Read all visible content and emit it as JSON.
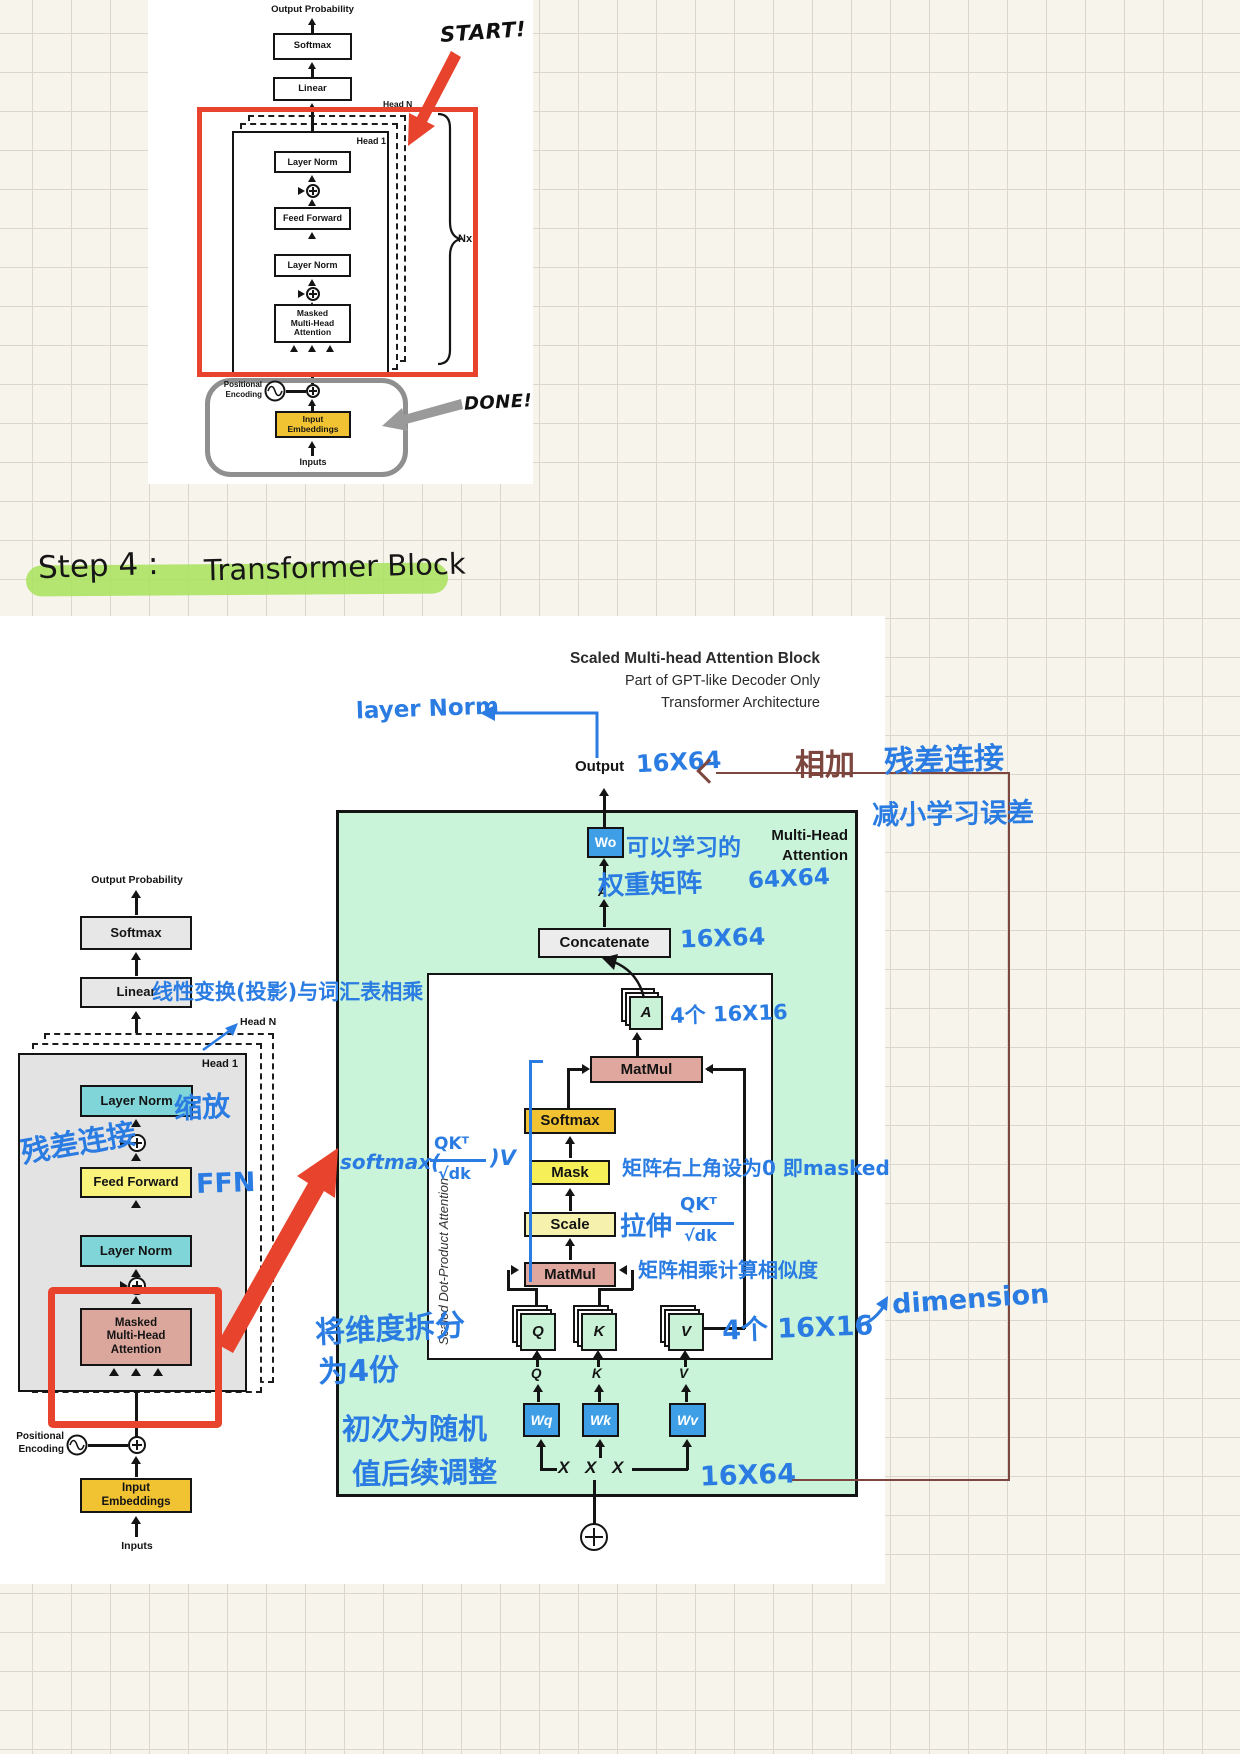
{
  "colors": {
    "accent_red": "#e8432c",
    "arrow_gray": "#999999",
    "highlight_green": "#a8e25c",
    "attention_panel_green": "#c9f4d9",
    "blue_weight_box": "#3f9fe6",
    "matmul_pink": "#dfa79d",
    "softmax_gold": "#f1c232",
    "mask_yellow": "#f7ef58",
    "scale_pale_yellow": "#f6f2ae",
    "layernorm_cyan": "#7fd5d7",
    "feedforward_yellow": "#f9f37c",
    "mha_pink": "#dba69c",
    "embedding_gold": "#f1c232",
    "handwriting_blue": "#2a7ce2",
    "handwriting_darkred": "#7d463e"
  },
  "top_diagram": {
    "output_probability": "Output Probability",
    "softmax": "Softmax",
    "linear": "Linear",
    "head_n": "Head N",
    "head_1": "Head 1",
    "layer_norm_1": "Layer Norm",
    "feed_forward": "Feed Forward",
    "layer_norm_2": "Layer Norm",
    "mha_lines": [
      "Masked",
      "Multi-Head",
      "Attention"
    ],
    "nx": "Nx",
    "positional_lines": [
      "Positional",
      "Encoding"
    ],
    "embed_lines": [
      "Input",
      "Embeddings"
    ],
    "inputs": "Inputs",
    "start": "START!",
    "done": "DONE!"
  },
  "step_title": {
    "prefix": "Step 4 :",
    "name": "Transformer Block"
  },
  "main": {
    "title1": "Scaled Multi-head Attention Block",
    "title2": "Part of GPT-like Decoder Only",
    "title3": "Transformer Architecture",
    "output": "Output",
    "left": {
      "output_probability": "Output Probability",
      "softmax": "Softmax",
      "linear": "Linear",
      "head_n": "Head N",
      "head_1": "Head 1",
      "layer_norm_1": "Layer Norm",
      "feed_forward": "Feed Forward",
      "layer_norm_2": "Layer Norm",
      "mha_lines": [
        "Masked",
        "Multi-Head",
        "Attention"
      ],
      "positional_lines": [
        "Positional",
        "Encoding"
      ],
      "embed_lines": [
        "Input",
        "Embeddings"
      ],
      "inputs": "Inputs"
    },
    "attn": {
      "mh_lines": [
        "Multi-Head",
        "Attention"
      ],
      "wo": "Wo",
      "a_small": "A",
      "concatenate": "Concatenate",
      "sdpa": "Scaled Dot-Product Attention",
      "a_card": "A",
      "matmul_top": "MatMul",
      "softmax": "Softmax",
      "mask": "Mask",
      "scale": "Scale",
      "matmul_bottom": "MatMul",
      "q": "Q",
      "k": "K",
      "v": "V",
      "q_label": "Q",
      "k_label": "K",
      "v_label": "V",
      "wq": "Wq",
      "wk": "Wk",
      "wv": "Wv",
      "x1": "X",
      "x2": "X",
      "x3": "X"
    },
    "notes": {
      "layer_norm": "layer Norm",
      "out_dim": "16X64",
      "add": "相加",
      "residual": "残差连接",
      "reduce_err": "减小学习误差",
      "learnable": "可以学习的",
      "weight_matrix": "权重矩阵",
      "wo_dim": "64X64",
      "concat_dim": "16X64",
      "a_count": "4个 16X16",
      "formula_pre": "softmax(",
      "formula_num": "QKᵀ",
      "formula_den": "√dk",
      "formula_post": ")V",
      "mask_note": "矩阵右上角设为0 即masked",
      "stretch": "拉伸",
      "stretch_num": "QKᵀ",
      "stretch_den": "√dk",
      "matmul_note": "矩阵相乘计算相似度",
      "split1": "将维度拆分",
      "split2": "为4份",
      "qkv_count": "4个 16X16",
      "dimension": "dimension",
      "init1": "初次为随机",
      "init2": "值后续调整",
      "in_dim": "16X64",
      "linear_note": "线性变换(投影)与词汇表相乘",
      "scale_zh": "缩放",
      "residual_zh": "残差连接",
      "ffn": "FFN"
    }
  }
}
